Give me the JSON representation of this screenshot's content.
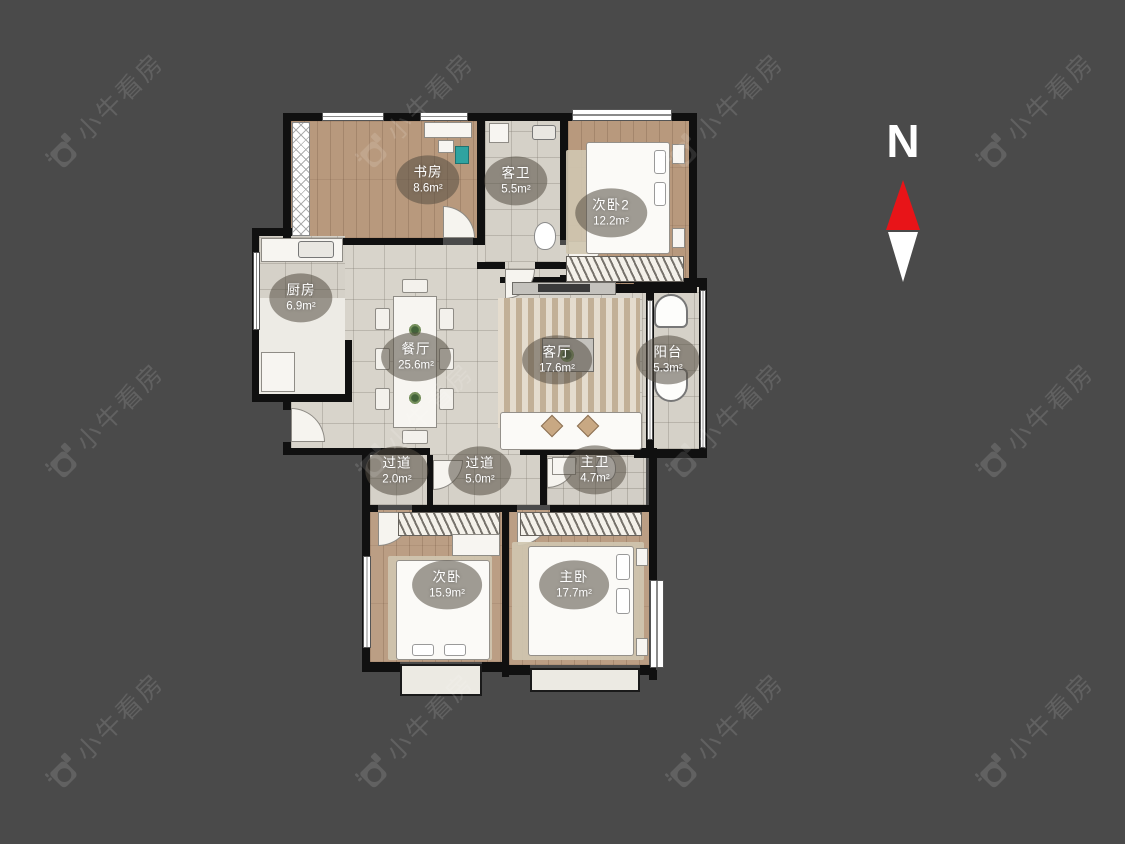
{
  "compass": {
    "label": "N"
  },
  "watermark": {
    "text": "小牛看房",
    "logo": "camera-icon"
  },
  "colors": {
    "background": "#4a4a4a",
    "wall": "#101010",
    "north_arrow": "#e81418",
    "south_arrow": "#ffffff"
  },
  "rooms": [
    {
      "id": "study",
      "name": "书房",
      "area": "8.6m²"
    },
    {
      "id": "guest-bath",
      "name": "客卫",
      "area": "5.5m²"
    },
    {
      "id": "bedroom-2",
      "name": "次卧2",
      "area": "12.2m²"
    },
    {
      "id": "kitchen",
      "name": "厨房",
      "area": "6.9m²"
    },
    {
      "id": "dining-room",
      "name": "餐厅",
      "area": "25.6m²"
    },
    {
      "id": "living-room",
      "name": "客厅",
      "area": "17.6m²"
    },
    {
      "id": "balcony",
      "name": "阳台",
      "area": "5.3m²"
    },
    {
      "id": "hallway-2",
      "name": "过道",
      "area": "2.0m²"
    },
    {
      "id": "hallway-1",
      "name": "过道",
      "area": "5.0m²"
    },
    {
      "id": "master-bath",
      "name": "主卫",
      "area": "4.7m²"
    },
    {
      "id": "bedroom-1",
      "name": "次卧",
      "area": "15.9m²"
    },
    {
      "id": "master-bedroom",
      "name": "主卧",
      "area": "17.7m²"
    }
  ]
}
